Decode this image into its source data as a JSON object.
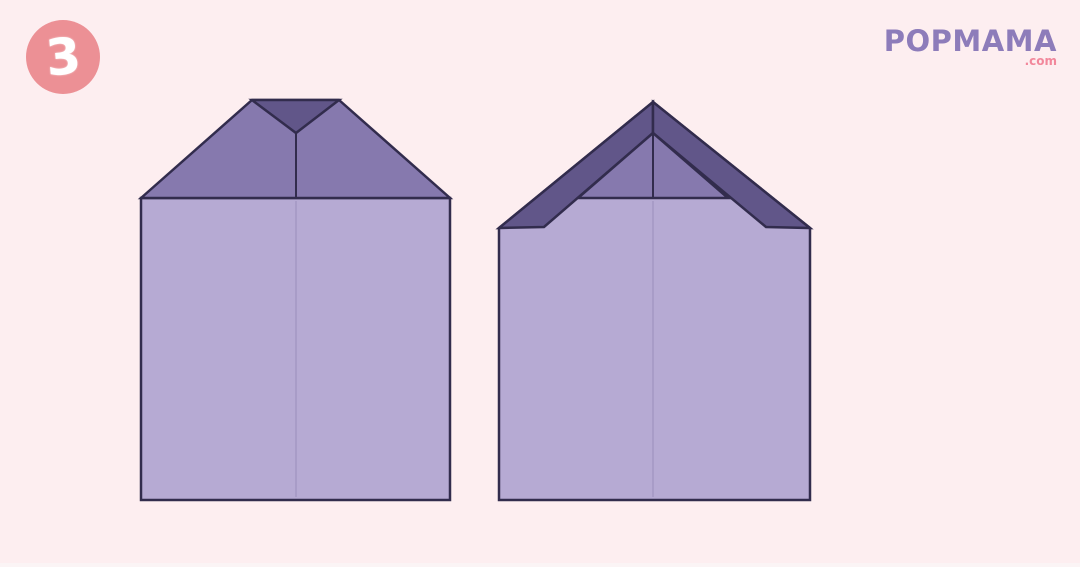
{
  "page": {
    "background_color": "#fdeef0",
    "footer_strip_color": "#fbf4f5"
  },
  "step_badge": {
    "number": "3",
    "circle_color": "#ec9095",
    "number_color": "#ffffff"
  },
  "logo": {
    "brand": "POPMAMA",
    "suffix": ".com",
    "brand_color": "#8d7cba",
    "suffix_color": "#f2879b"
  },
  "palette": {
    "paper_light": "#b6aad3",
    "paper_medium": "#8679ae",
    "paper_dark": "#615689",
    "outline": "#322c4d",
    "crease_faint": "#a89cc7"
  },
  "figures": {
    "left": {
      "body_points": "141,198 450,198 450,500 141,500",
      "roof_points": "141,198 252,100 339,100 450,198",
      "gap_triangle_points": "252,100 339,100 296,133",
      "center_crease_top": {
        "x1": "296",
        "y1": "133",
        "x2": "296",
        "y2": "198"
      },
      "center_crease_body": {
        "x1": "296",
        "y1": "201",
        "x2": "296",
        "y2": "497"
      }
    },
    "right": {
      "body_points": "499,228 653,102 810,228 810,500 499,500",
      "band_left_points": "499,228 653,102 653,133 544,227",
      "band_right_points": "810,228 653,102 653,133 766,227",
      "inner_triangle_points": "653,133 578,198 728,198",
      "center_crease_top": {
        "x1": "653",
        "y1": "104",
        "x2": "653",
        "y2": "198"
      },
      "center_crease_body": {
        "x1": "653",
        "y1": "201",
        "x2": "653",
        "y2": "497"
      }
    }
  }
}
